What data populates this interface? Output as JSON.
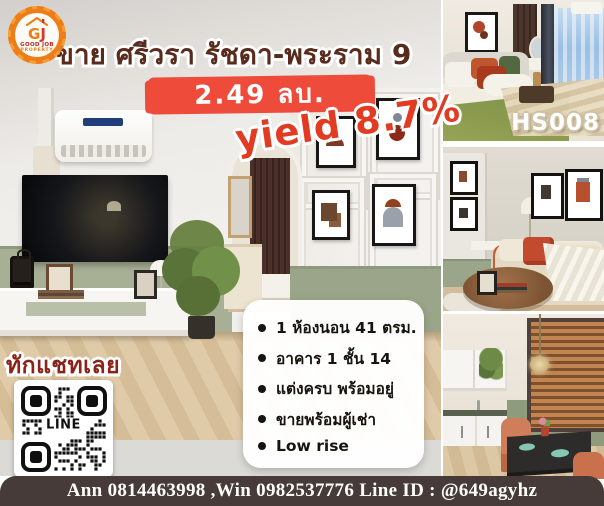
{
  "badge": {
    "initial_g": "G",
    "initial_j": "J",
    "name": "GOOD JOB",
    "type": "PROPERTY"
  },
  "listing": {
    "title": "ขาย ศรีวรา รัชดา-พระราม 9",
    "price": "2.49 ลบ.",
    "yield": "yield 8.7%",
    "code": "HS008"
  },
  "features": {
    "items": [
      "1 ห้องนอน  41 ตรม.",
      "อาคาร 1 ชั้น 14",
      "แต่งครบ พร้อมอยู่",
      "ขายพร้อมผู้เช่า",
      "Low rise"
    ]
  },
  "chat": {
    "cta": "ทักแชทเลย",
    "qr_label": "LINE"
  },
  "footer": {
    "contact": "Ann 0814463998 ,Win 0982537776 Line ID : @649agyhz"
  },
  "colors": {
    "price_bg": "#ee4b3b",
    "title_text": "#582b1c",
    "yield_text": "#e23b22",
    "cta_text": "#8a2418",
    "footer_bg": "#463b38",
    "badge_orange": "#ee7d18",
    "badge_red": "#cf3a2a",
    "wainscot_green": "#a7b095",
    "wood_floor": "#dcc5a4"
  }
}
